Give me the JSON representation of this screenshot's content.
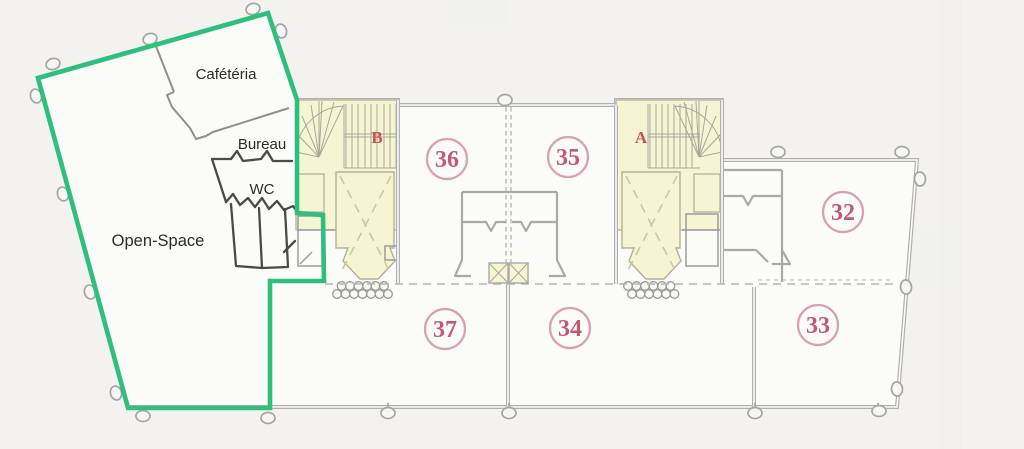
{
  "canvas": {
    "width": 1024,
    "height": 449
  },
  "rooms": {
    "cafeteria": "Cafétéria",
    "bureau": "Bureau",
    "wc": "WC",
    "open_space": "Open-Space"
  },
  "stairwells": {
    "a": "A",
    "b": "B"
  },
  "zones": [
    {
      "number": "36"
    },
    {
      "number": "35"
    },
    {
      "number": "32"
    },
    {
      "number": "37"
    },
    {
      "number": "34"
    },
    {
      "number": "33"
    }
  ],
  "colors": {
    "highlight_green": "#2fbf7d",
    "zone_ring_pink": "#d9a0ad",
    "zone_number_pink": "#c05a72",
    "stair_letter_red": "#c94f4f",
    "wall_gray": "#b0b0b0",
    "dark_partition": "#4a4a4a",
    "stair_fill_yellow": "#f5f4d3",
    "background": "#f3f2ef"
  }
}
